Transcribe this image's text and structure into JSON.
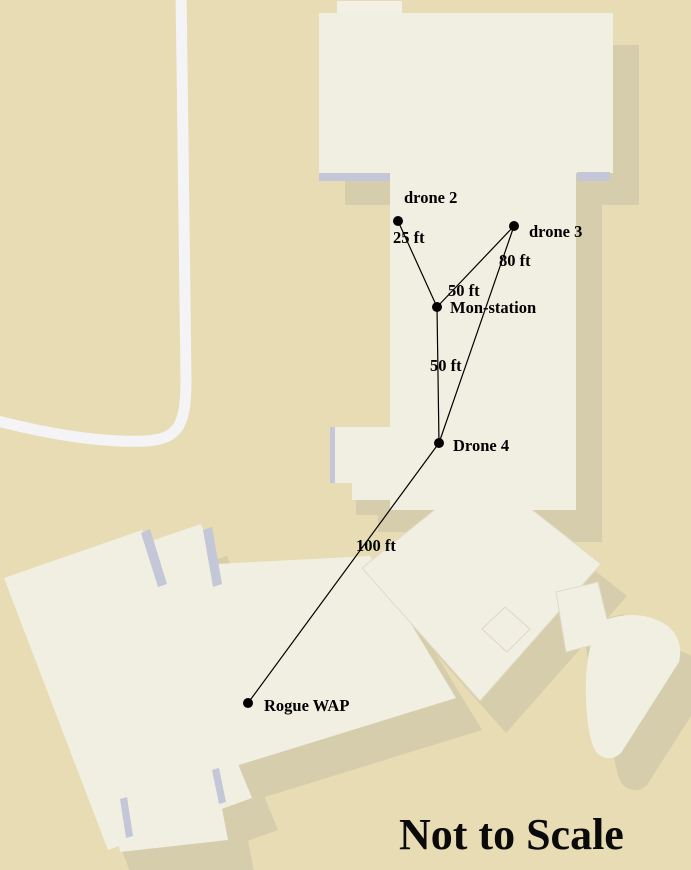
{
  "map": {
    "footer_note": "Not to Scale"
  },
  "network": {
    "nodes": [
      {
        "id": "drone-2",
        "label": "drone 2",
        "x": 398,
        "y": 221,
        "label_x": 404,
        "label_y": 203
      },
      {
        "id": "drone-3",
        "label": "drone 3",
        "x": 514,
        "y": 226,
        "label_x": 529,
        "label_y": 237
      },
      {
        "id": "mon-station",
        "label": "Mon-station",
        "x": 437,
        "y": 307,
        "label_x": 450,
        "label_y": 313
      },
      {
        "id": "drone-4",
        "label": "Drone 4",
        "x": 439,
        "y": 443,
        "label_x": 453,
        "label_y": 451
      },
      {
        "id": "rogue-wap",
        "label": "Rogue WAP",
        "x": 248,
        "y": 703,
        "label_x": 264,
        "label_y": 711
      }
    ],
    "links": [
      {
        "from": "drone-2",
        "to": "mon-station",
        "distance": "25 ft",
        "label_x": 393,
        "label_y": 243
      },
      {
        "from": "drone-3",
        "to": "mon-station",
        "distance": "50 ft",
        "label_x": 448,
        "label_y": 296
      },
      {
        "from": "drone-3",
        "to": "drone-4",
        "distance": "80 ft",
        "label_x": 499,
        "label_y": 266
      },
      {
        "from": "mon-station",
        "to": "drone-4",
        "distance": "50 ft",
        "label_x": 430,
        "label_y": 371
      },
      {
        "from": "drone-4",
        "to": "rogue-wap",
        "distance": "100 ft",
        "label_x": 356,
        "label_y": 551
      }
    ]
  },
  "colors": {
    "background": "#e7dcb3",
    "building": "#f1efe2",
    "building_shadow": "#d6cdad",
    "edge_accent": "#c4c7d7",
    "road": "#f4f4f6",
    "ink": "#000000"
  }
}
